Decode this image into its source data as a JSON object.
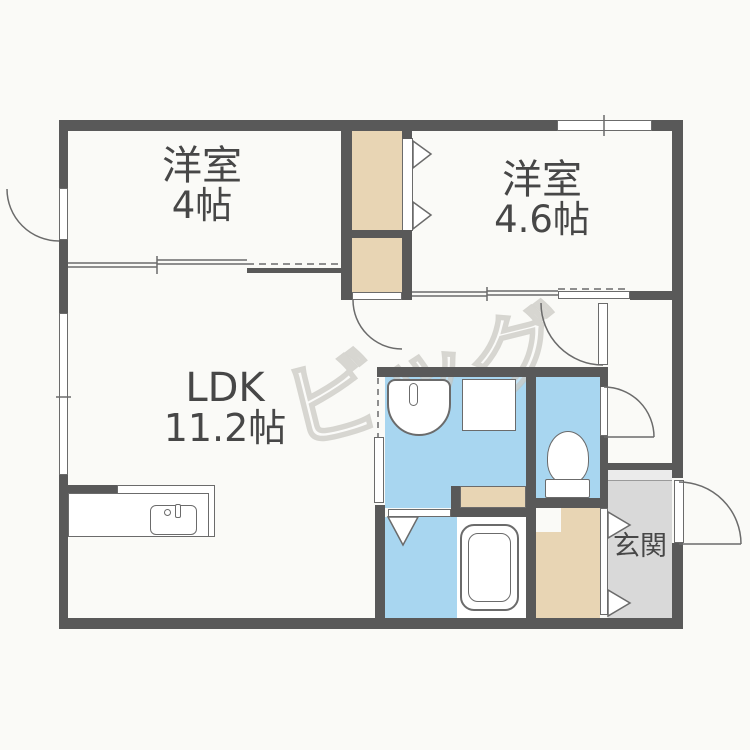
{
  "plan": {
    "title": "floor-plan",
    "rooms": [
      {
        "label": "洋室",
        "area": "4帖"
      },
      {
        "label": "洋室",
        "area": "4.6帖"
      },
      {
        "label": "LDK",
        "area": "11.2帖"
      },
      {
        "label": "玄関",
        "area": ""
      }
    ],
    "watermark": "ビッグ",
    "colors": {
      "wall": "#595959",
      "storage_tan": "#e8d5b4",
      "wet_area_blue": "#a8d6f0",
      "genkan_gray": "#d9d9d9",
      "background": "#fafaf7",
      "text": "#474747"
    }
  }
}
